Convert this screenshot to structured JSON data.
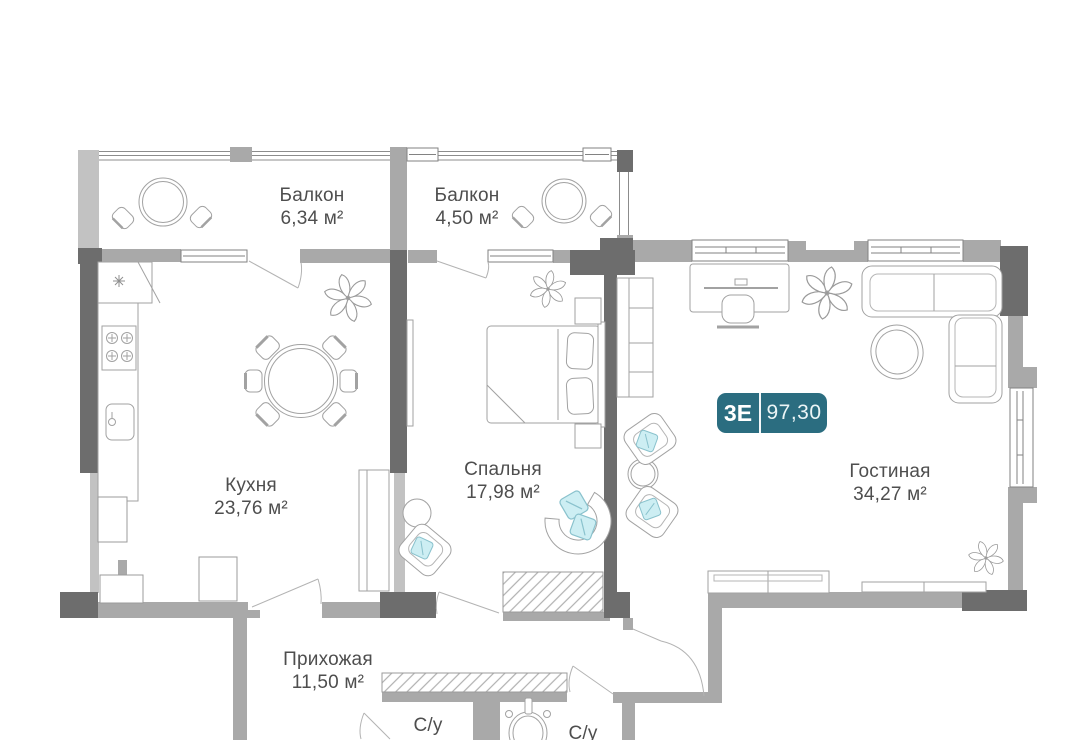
{
  "plan": {
    "badge": {
      "type_label": "3Е",
      "total_area": "97,30",
      "color": "#2b6d80"
    },
    "colors": {
      "accent_pillow": "#cdeef3",
      "wall_dark": "#6d6d6d",
      "wall_mid": "#a9a9a9"
    },
    "rooms": [
      {
        "id": "balcony-1",
        "name": "Балкон",
        "area": "6,34 м²"
      },
      {
        "id": "balcony-2",
        "name": "Балкон",
        "area": "4,50 м²"
      },
      {
        "id": "kitchen",
        "name": "Кухня",
        "area": "23,76 м²"
      },
      {
        "id": "bedroom",
        "name": "Спальня",
        "area": "17,98 м²"
      },
      {
        "id": "living",
        "name": "Гостиная",
        "area": "34,27 м²"
      },
      {
        "id": "hallway",
        "name": "Прихожая",
        "area": "11,50 м²"
      },
      {
        "id": "bathroom-1",
        "name": "С/у"
      },
      {
        "id": "bathroom-2",
        "name": "С/у"
      }
    ]
  }
}
